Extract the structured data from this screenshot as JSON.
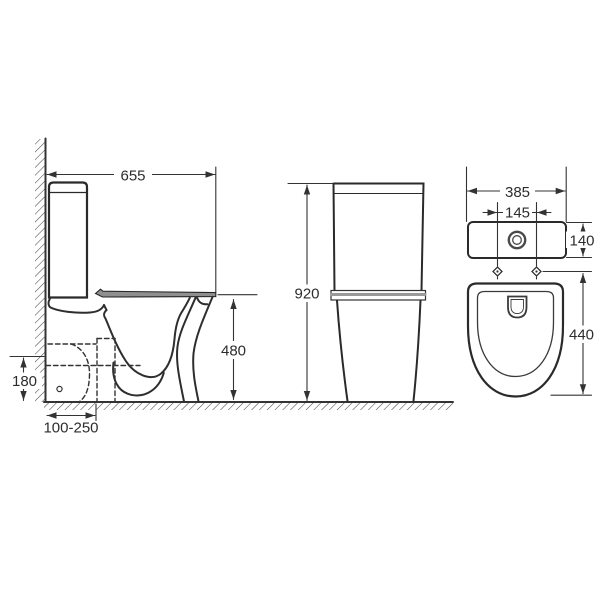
{
  "drawing": {
    "side_view": {
      "width_label": "655",
      "seat_height_label": "480",
      "trap_height_label": "180",
      "setout_label": "100-250"
    },
    "rear_view": {
      "height_label": "920"
    },
    "front_view": {
      "width_label": "385",
      "fixing_centres_label": "145",
      "cistern_depth_label": "140",
      "bowl_depth_label": "440"
    }
  },
  "colors": {
    "line": "#3a3a3a",
    "object_line": "#2a2a2a",
    "seat_gray": "#8f8f8f",
    "band_gray": "#9a9a9a",
    "background": "#ffffff"
  }
}
